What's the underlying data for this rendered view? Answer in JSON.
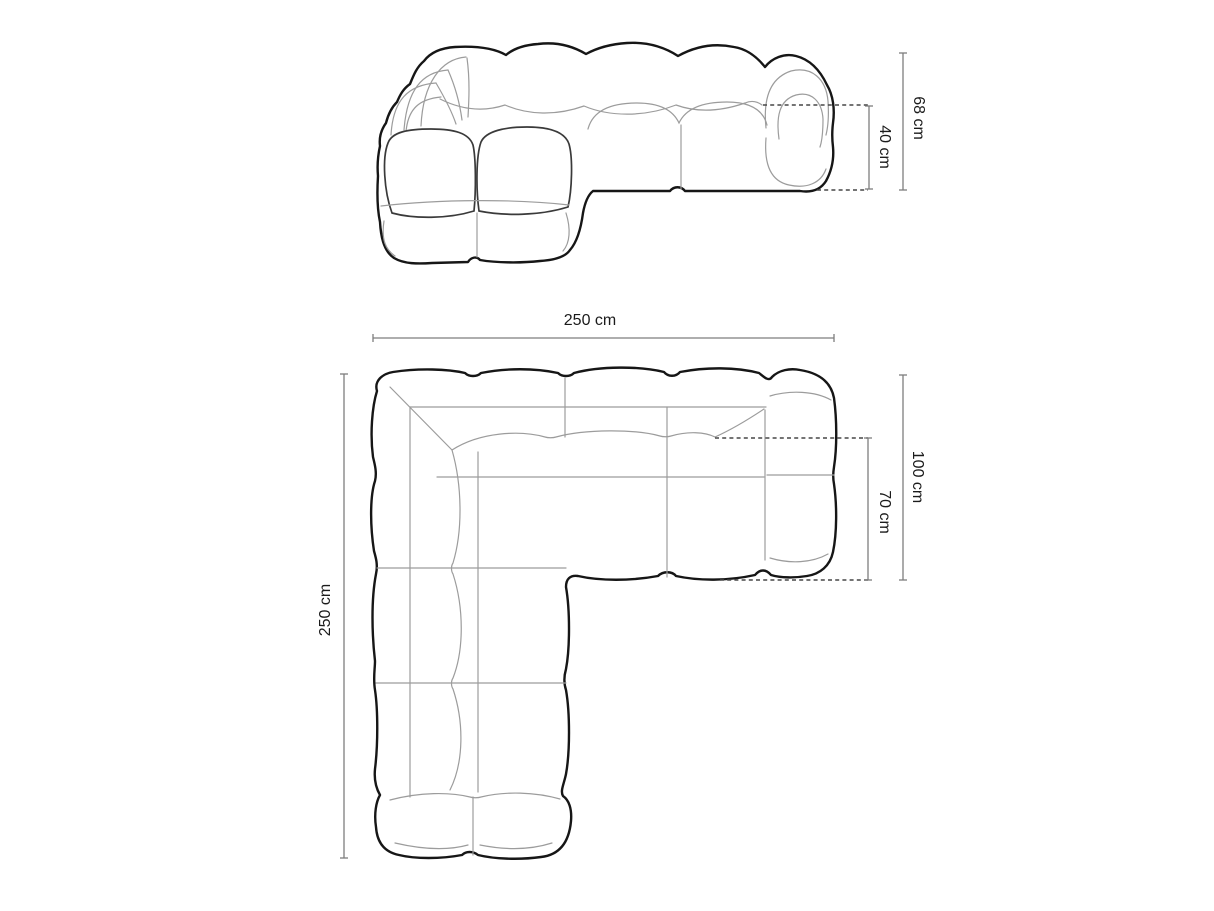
{
  "page": {
    "title": "Modular corner sofa dimension diagram",
    "background_color": "#ffffff",
    "outline_color": "#161616",
    "seam_color": "#9c9c9c",
    "dimension_line_color": "#7e7e7e",
    "text_color": "#1b1b1b",
    "unit": "cm"
  },
  "front_view": {
    "dimensions": [
      {
        "id": "total-height",
        "label": "68 cm",
        "value": 68,
        "unit": "cm",
        "orientation": "vertical"
      },
      {
        "id": "seat-height",
        "label": "40 cm",
        "value": 40,
        "unit": "cm",
        "orientation": "vertical"
      }
    ]
  },
  "top_view": {
    "dimensions": [
      {
        "id": "total-width",
        "label": "250 cm",
        "value": 250,
        "unit": "cm",
        "orientation": "horizontal"
      },
      {
        "id": "total-depth",
        "label": "250 cm",
        "value": 250,
        "unit": "cm",
        "orientation": "vertical"
      },
      {
        "id": "right-section-depth",
        "label": "100 cm",
        "value": 100,
        "unit": "cm",
        "orientation": "vertical"
      },
      {
        "id": "seat-depth",
        "label": "70 cm",
        "value": 70,
        "unit": "cm",
        "orientation": "vertical"
      }
    ]
  }
}
